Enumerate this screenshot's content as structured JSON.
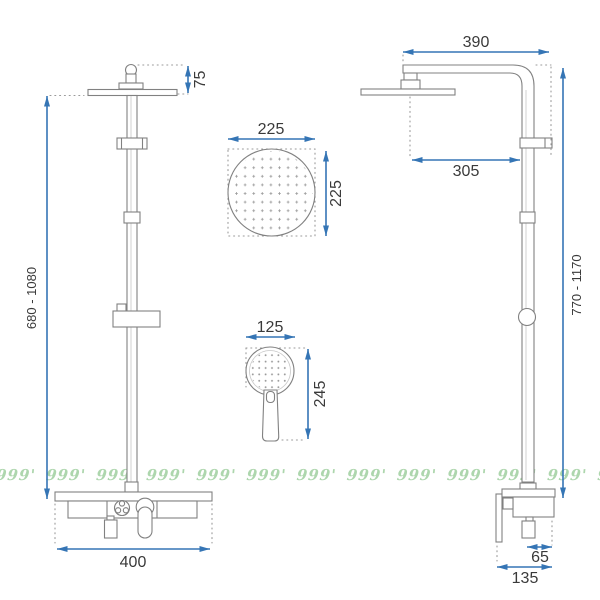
{
  "drawing_title": "shower-set-dimension-drawing",
  "dims": {
    "front_height": "680 - 1080",
    "head_height": "75",
    "front_width": "400",
    "overhead_width": "225",
    "overhead_height": "225",
    "hand_width": "125",
    "hand_height": "245",
    "side_arm_width": "390",
    "side_arm_reach": "305",
    "side_height": "770 - 1170",
    "side_outlet_offset": "65",
    "side_depth": "135"
  },
  "watermark": {
    "text": "999' 999' 999' 999' 999' 999' 999' 999' 999' 999' 999' 999' 999' 999' 999' 999' 999' 999' 999' 999' 999' 999'"
  },
  "colors": {
    "dimension_blue": "#3575b5",
    "drawing_gray": "#818181",
    "text_dark": "#3a3a3a",
    "watermark_green": "#7cbd7c",
    "background": "#ffffff"
  }
}
